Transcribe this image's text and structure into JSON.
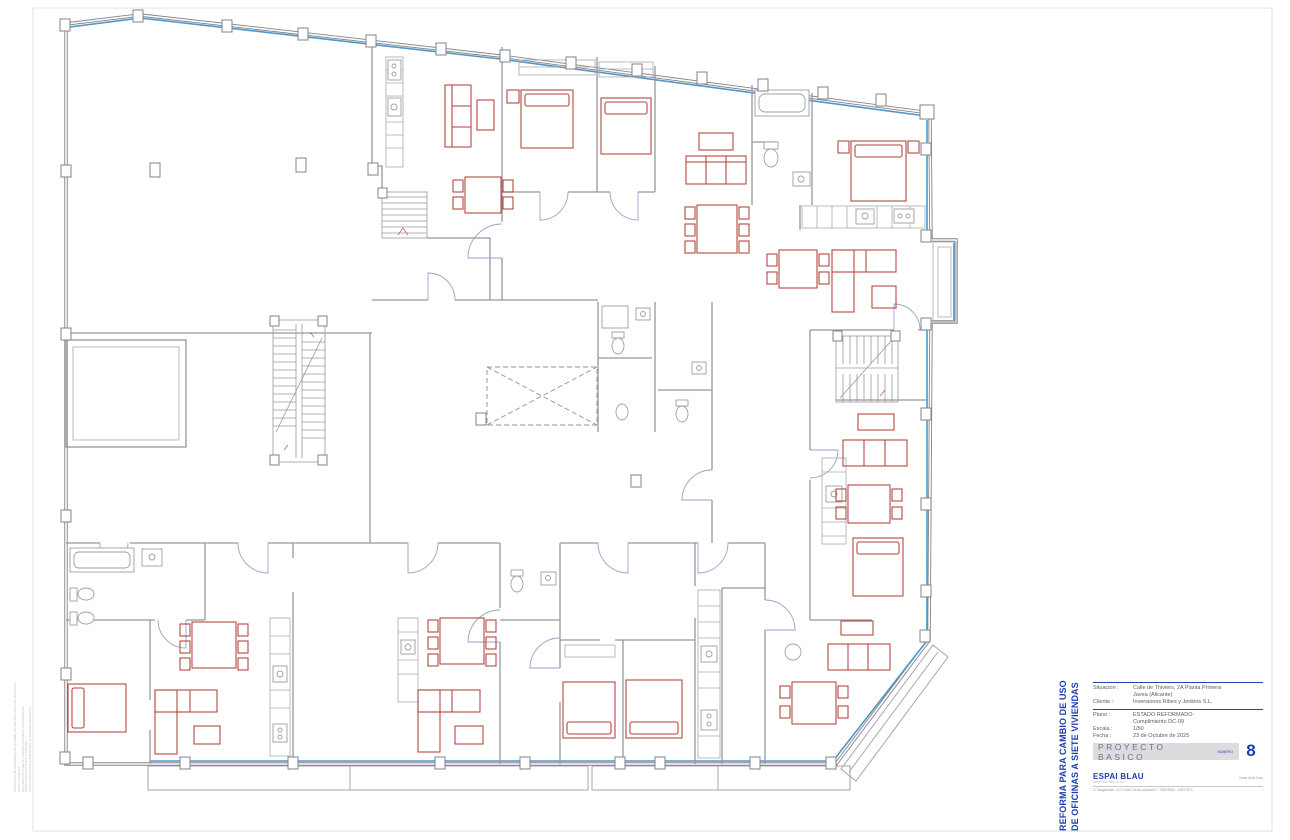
{
  "title_block": {
    "project_title_line1": "REFORMA PARA CAMBIO DE USO",
    "project_title_line2": "DE OFICINAS A SIETE VIVIENDAS",
    "fields": [
      {
        "label": "Situacion :",
        "value": "Calle de Thiviers, 2A Planta Primera",
        "value2": "Javea (Alicante)"
      },
      {
        "label": "Cliente :",
        "value": "Inversiones Ribes y Jenkins S.L."
      },
      {
        "label": "Plano :",
        "value": "ESTADO REFORMADO:",
        "value2": "Cumplimiento DC-09"
      },
      {
        "label": "Escala :",
        "value": "1/50"
      },
      {
        "label": "Fecha :",
        "value": "23 de Octubre de 2025"
      }
    ],
    "stage_label": "PROYECTO BASICO",
    "number_label": "NUMERO",
    "sheet_number": "8",
    "firm_name": "ESPAI BLAU",
    "firm_subtitle": "ARQUITECTES - S.L.P.",
    "architect_name": "Isaac Artal Soto",
    "firm_address": "C/ Magallanes, 21 2ª Izda. Denia (Alicante)   T. 96578383 - 63677874"
  },
  "margin_note": {
    "line1": "PROYECTO DE REFORMA PARA CAMBIO DE USO DE LOCAL DE OFICINAS A SIETE VIVIENDAS",
    "line2": "DOCUMENTO SUJETO A VISADO COLEGIAL. PROHIBIDA SU REPRODUCCION TOTAL O PARCIAL",
    "line3": "SIN AUTORIZACION EXPRESA DEL AUTOR DEL PROYECTO"
  },
  "drawing": {
    "icons": [
      "bed-icon",
      "sofa-icon",
      "dining-table-icon",
      "stairs-icon",
      "bathtub-icon",
      "toilet-icon",
      "sink-icon",
      "stove-icon",
      "void-cross-icon",
      "balcony-icon",
      "bay-window-icon",
      "door-arc-icon",
      "column-icon"
    ],
    "colors": {
      "wall_gray": "#83838a",
      "partition_gray": "#97979d",
      "furniture_red": "#b04038",
      "glazing_blue": "#4f97c8",
      "door_arc_blue": "#9aa2cc",
      "accent_blue": "#1b3db0",
      "bar_gray": "#dcdce0"
    }
  }
}
